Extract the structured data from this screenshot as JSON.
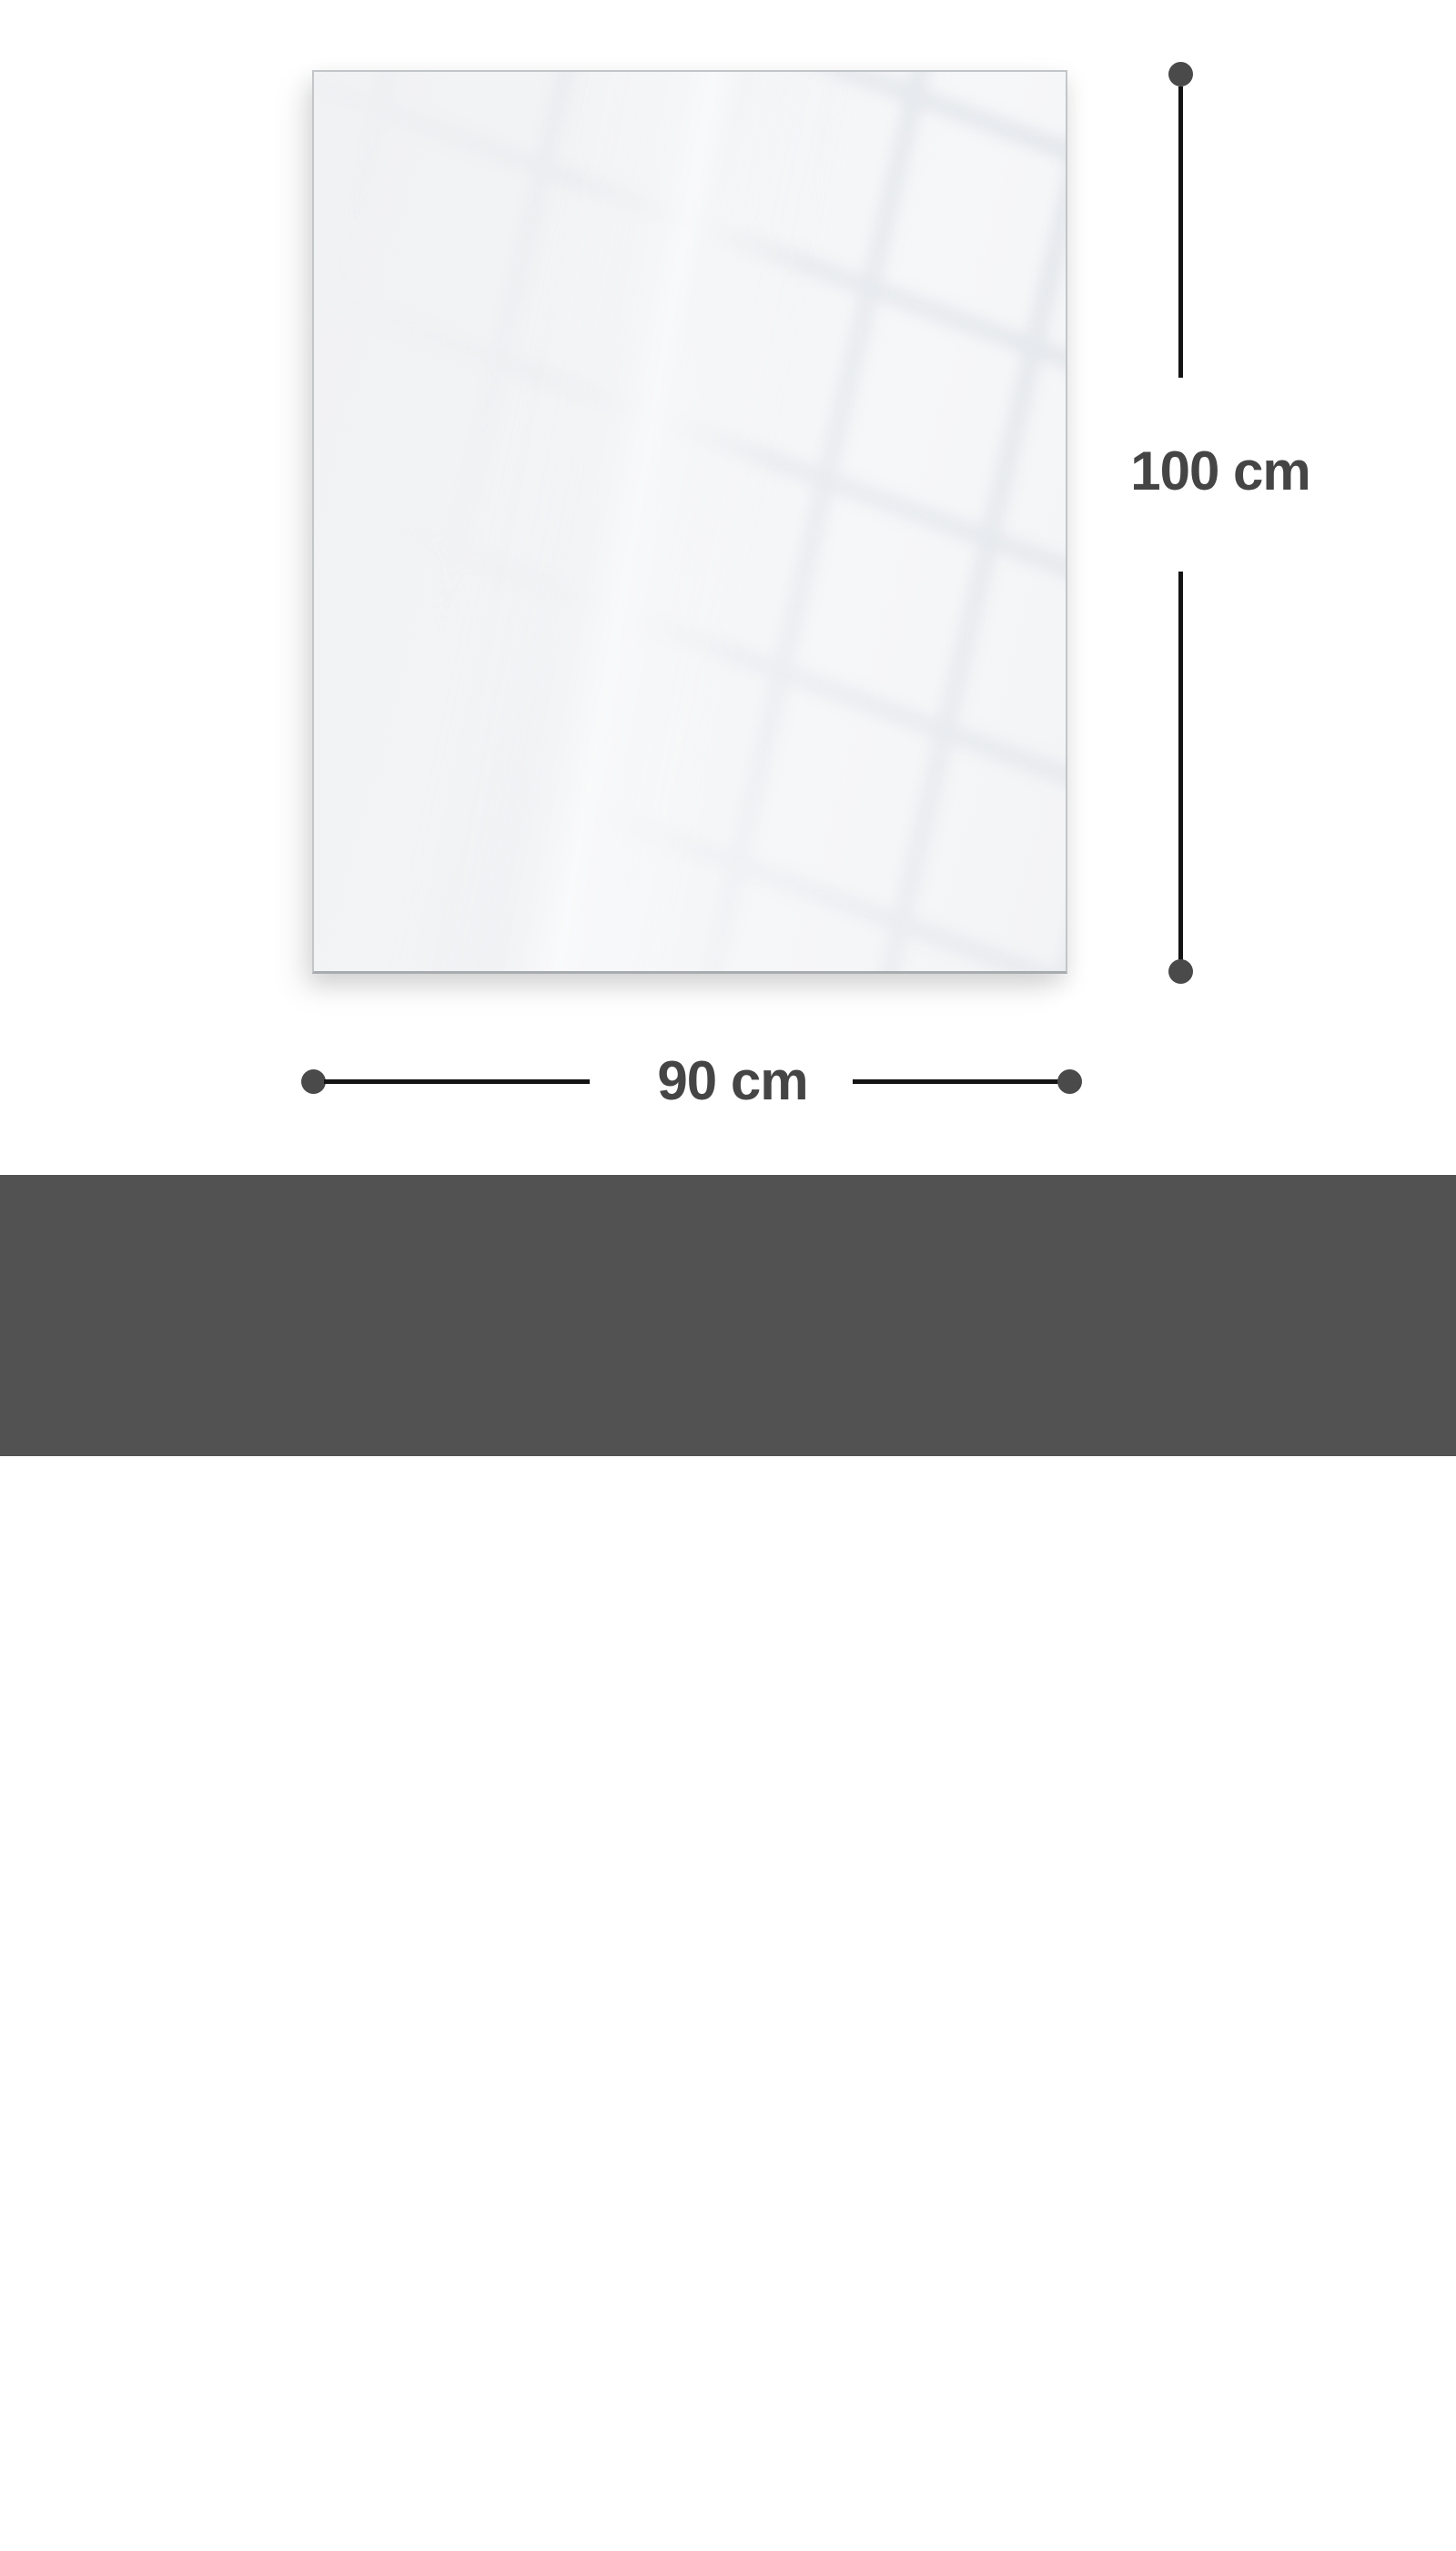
{
  "diagram": {
    "height_dimension": {
      "label": "100 cm"
    },
    "width_dimension": {
      "label": "90 cm"
    }
  },
  "footer": {
    "heading": "Gesamtgrösse | Size",
    "size_value": "90 x 100 cm"
  },
  "colors": {
    "background": "#ffffff",
    "panel_fill": "#f4f5f7",
    "panel_border": "#c2c6c9",
    "panel_border_bottom": "#a8acaf",
    "reflection_line": "#dee2e7",
    "dimension_line": "#141414",
    "dimension_dot": "#4a4a4a",
    "dimension_text": "#454545",
    "footer_background": "#525252",
    "footer_text": "#ffffff"
  }
}
